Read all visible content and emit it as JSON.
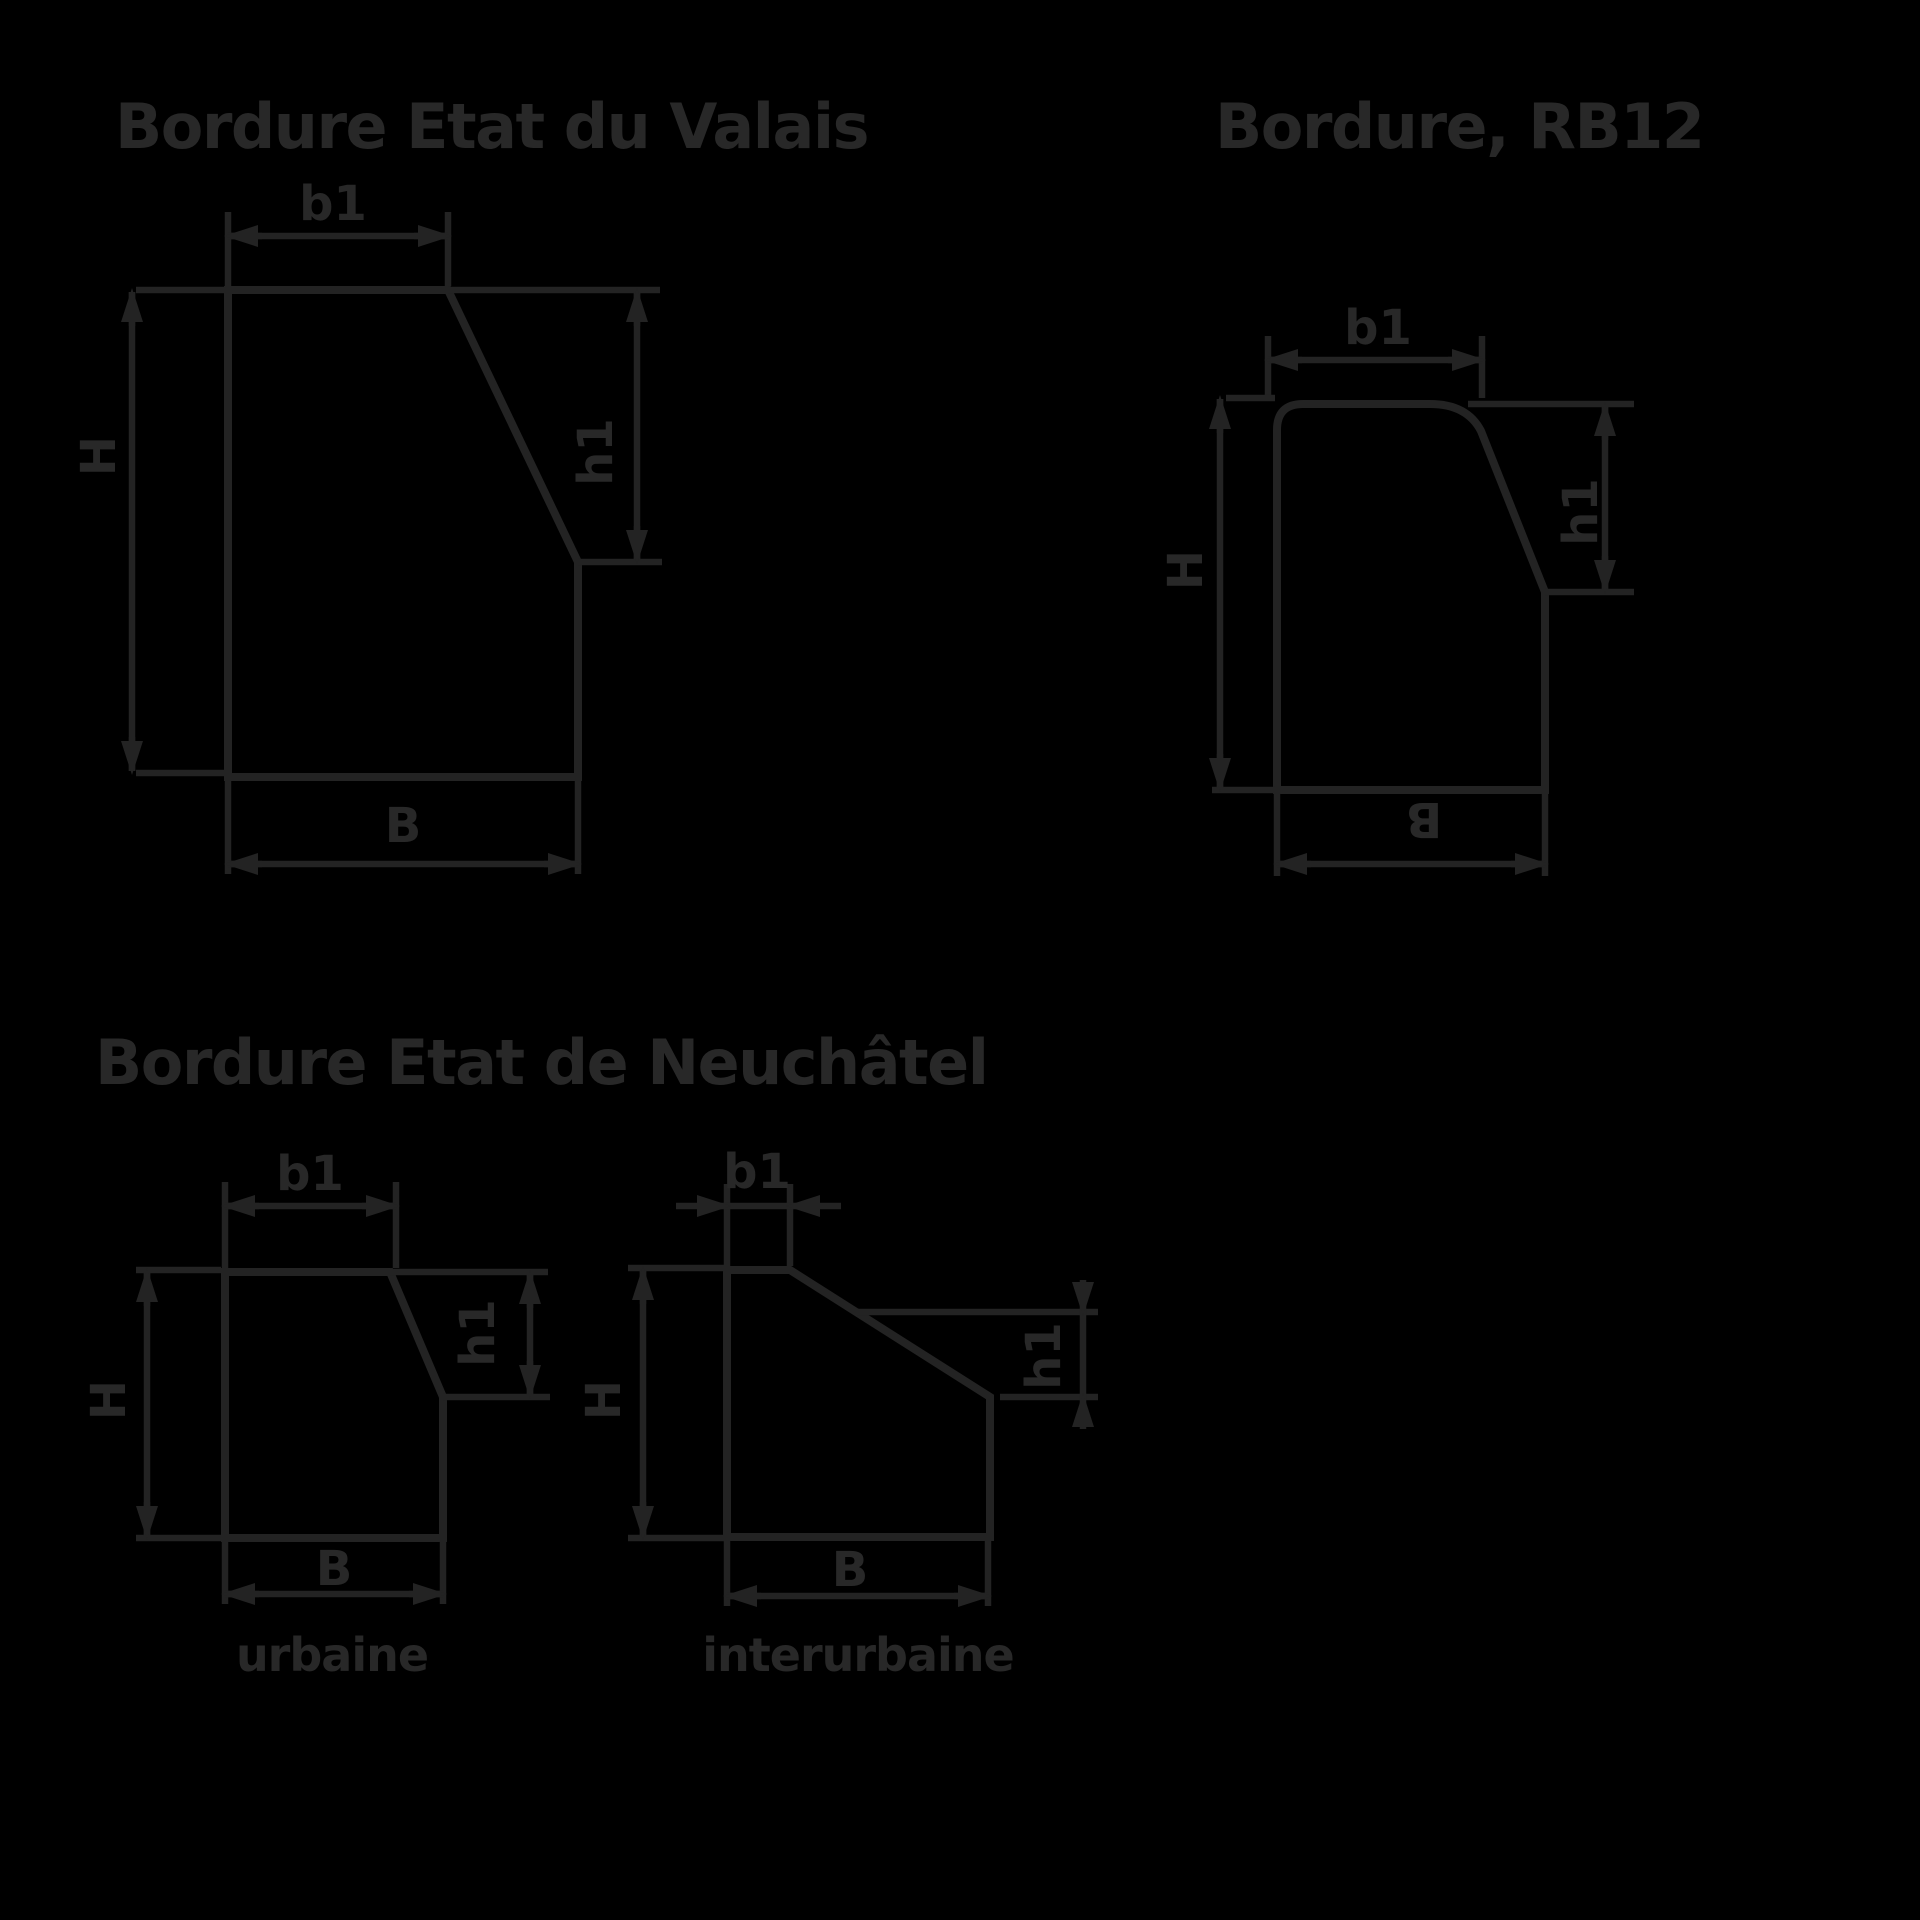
{
  "canvas": {
    "width": 1920,
    "height": 1920
  },
  "colors": {
    "background": "#000000",
    "line": "#232323",
    "text": "#282828"
  },
  "diagrams": {
    "valais": {
      "title": "Bordure Etat du Valais",
      "labels": {
        "top_width": "b1",
        "height": "H",
        "face_height": "h1",
        "base_width": "B"
      }
    },
    "rb12": {
      "title": "Bordure, RB12",
      "labels": {
        "top_width": "b1",
        "height": "H",
        "face_height": "h1",
        "base_width": "B"
      }
    },
    "neuchatel": {
      "title": "Bordure Etat de Neuchâtel",
      "urbaine": {
        "caption": "urbaine",
        "labels": {
          "top_width": "b1",
          "height": "H",
          "face_height": "h1",
          "base_width": "B"
        }
      },
      "interurbaine": {
        "caption": "interurbaine",
        "labels": {
          "top_width": "b1",
          "height": "H",
          "face_height": "h1",
          "base_width": "B"
        }
      }
    }
  }
}
